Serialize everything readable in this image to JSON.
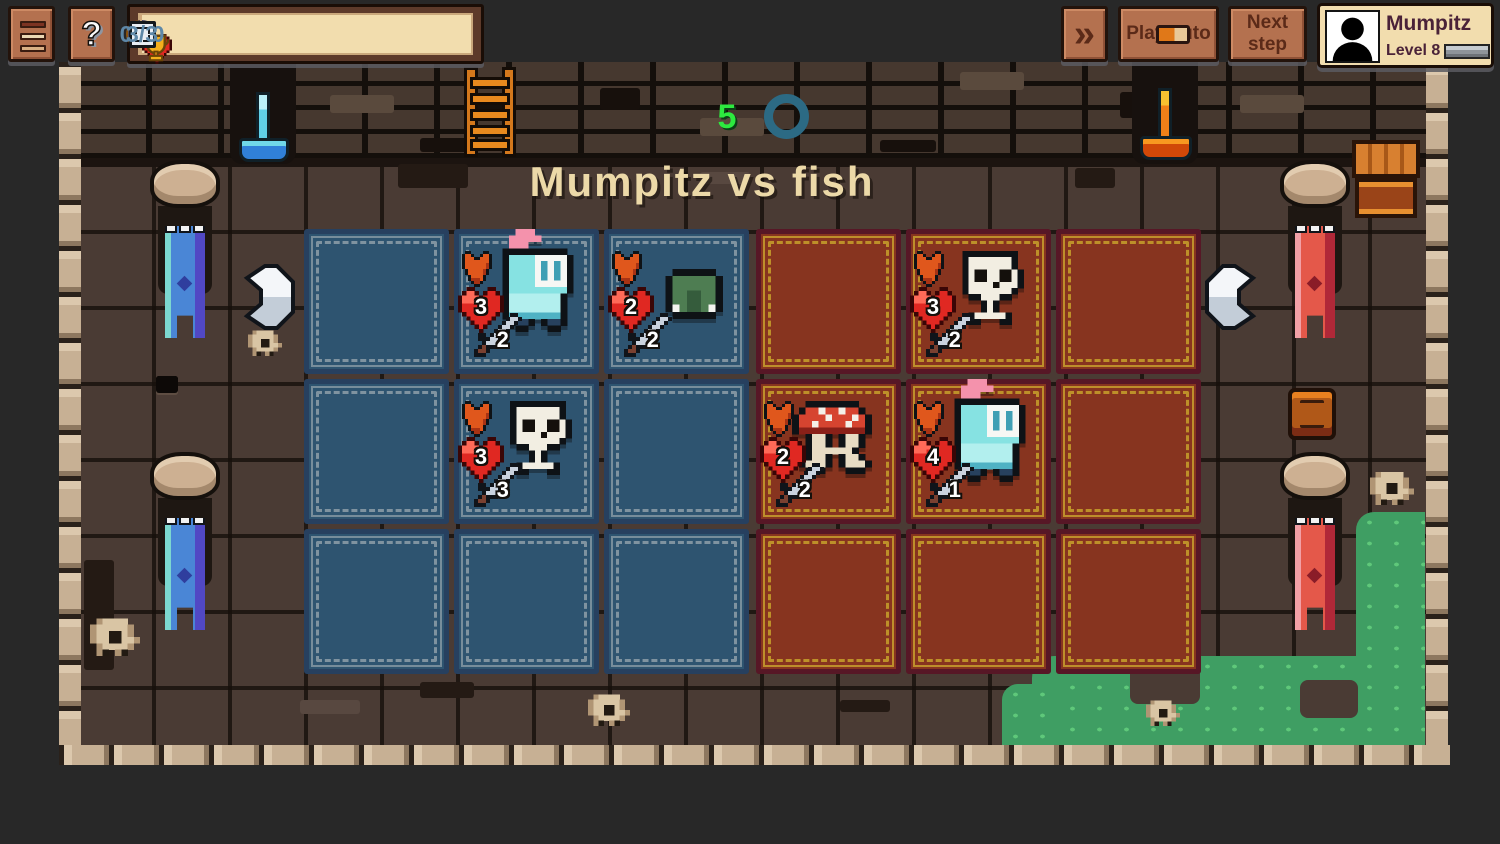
{
  "hud": {
    "menu_button": {
      "icon": "hamburger-icon"
    },
    "help_button": {
      "label": "?"
    },
    "stats": [
      {
        "id": "gold",
        "icon": "coin-icon",
        "value": "0"
      },
      {
        "id": "lives",
        "icon": "heart-icon",
        "value": "5"
      },
      {
        "id": "trophies",
        "icon": "trophy-icon",
        "value": "0/10"
      },
      {
        "id": "tokens",
        "icon": "token-icon",
        "value": "1"
      },
      {
        "id": "rerolls",
        "icon": "dice-icon",
        "value": "3/3"
      }
    ],
    "fast_forward_button": {
      "glyph": "»",
      "icon": "fast-forward-icon"
    },
    "play_auto_button": {
      "label": "Play auto",
      "toggle_on": true
    },
    "next_step_button": {
      "label": "Next step"
    },
    "profile": {
      "name": "Mumpitz",
      "level": "Level 8"
    }
  },
  "battle": {
    "title": "Mumpitz vs fish",
    "round_counter": "5"
  },
  "board": {
    "grid_size": {
      "rows": 3,
      "cols": 3
    },
    "teams": [
      {
        "side": "blue",
        "units": [
          {
            "row": 0,
            "col": 1,
            "type": "knight",
            "hp": "3",
            "attack": "2"
          },
          {
            "row": 0,
            "col": 2,
            "type": "slime",
            "hp": "2",
            "attack": "2"
          },
          {
            "row": 1,
            "col": 1,
            "type": "skeleton",
            "hp": "3",
            "attack": "3"
          }
        ]
      },
      {
        "side": "red",
        "units": [
          {
            "row": 0,
            "col": 1,
            "type": "skeleton",
            "hp": "3",
            "attack": "2"
          },
          {
            "row": 1,
            "col": 0,
            "type": "mushroom",
            "hp": "2",
            "attack": "2"
          },
          {
            "row": 1,
            "col": 1,
            "type": "knight",
            "hp": "4",
            "attack": "1"
          }
        ]
      }
    ]
  },
  "colors": {
    "background": "#282828",
    "blue_cell": "#2e5470",
    "red_cell": "#87341f",
    "hud_panel": "#f2ddae",
    "button_brown": "#b4714f",
    "stat_number": "#5e88a8",
    "title_cream": "#ecd9a8",
    "round_green": "#2de93f",
    "grass_green": "#3f9e63",
    "heart_red": "#e02822",
    "accent_gold": "#f6b82a"
  }
}
